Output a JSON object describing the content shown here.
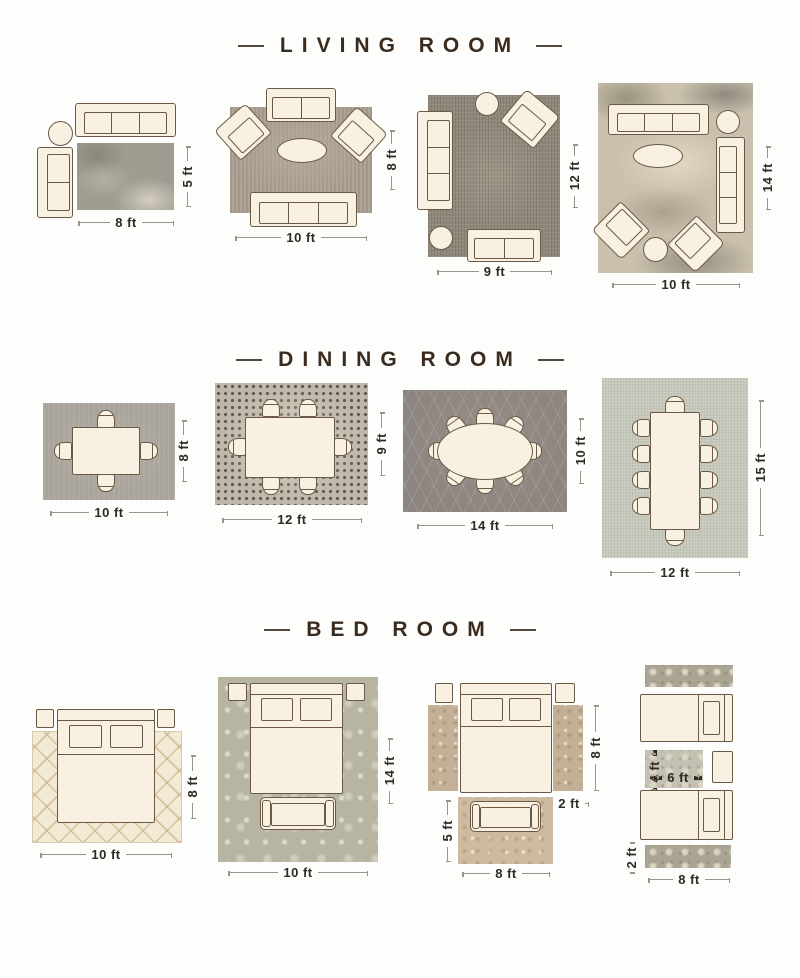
{
  "sections": [
    {
      "id": "living-room",
      "title": "LIVING ROOM",
      "layouts": [
        {
          "width_label": "8 ft",
          "height_label": "5 ft"
        },
        {
          "width_label": "10 ft",
          "height_label": "8 ft"
        },
        {
          "width_label": "9 ft",
          "height_label": "12 ft"
        },
        {
          "width_label": "10 ft",
          "height_label": "14 ft"
        }
      ]
    },
    {
      "id": "dining-room",
      "title": "DINING ROOM",
      "layouts": [
        {
          "width_label": "10 ft",
          "height_label": "8 ft"
        },
        {
          "width_label": "12 ft",
          "height_label": "9 ft"
        },
        {
          "width_label": "14 ft",
          "height_label": "10 ft"
        },
        {
          "width_label": "12 ft",
          "height_label": "15 ft"
        }
      ]
    },
    {
      "id": "bed-room",
      "title": "BED ROOM",
      "layouts": [
        {
          "width_label": "10 ft",
          "height_label": "8 ft"
        },
        {
          "width_label": "10 ft",
          "height_label": "14 ft"
        },
        {
          "bedside_height_label": "8 ft",
          "bedside_width_label": "2 ft",
          "foot_height_label": "5 ft",
          "foot_width_label": "8 ft"
        },
        {
          "between_height_label": "4 ft",
          "between_width_label": "6 ft",
          "runner_height_label": "2 ft",
          "runner_width_label": "8 ft"
        }
      ]
    }
  ],
  "colors": {
    "cream": "#f8f1e2",
    "outline": "#6b5945",
    "title_brown": "#3a2b1f",
    "dim_text": "#2e2924",
    "dim_line": "#9a958c",
    "rug_lr1": "#a09c92",
    "rug_lr2": "#a89e90",
    "rug_lr3": "#8f897c",
    "rug_lr4": "#c9c0ad",
    "rug_dr1": "#a8a49b",
    "rug_dr2": "#beb8aa",
    "rug_dr3": "#8d8680",
    "rug_dr4": "#c6c7bb",
    "rug_br1": "#f3ead6",
    "rug_br2": "#b7b4a1",
    "rug_br3": "#c3b097",
    "rug_br4": "#aaa492"
  }
}
